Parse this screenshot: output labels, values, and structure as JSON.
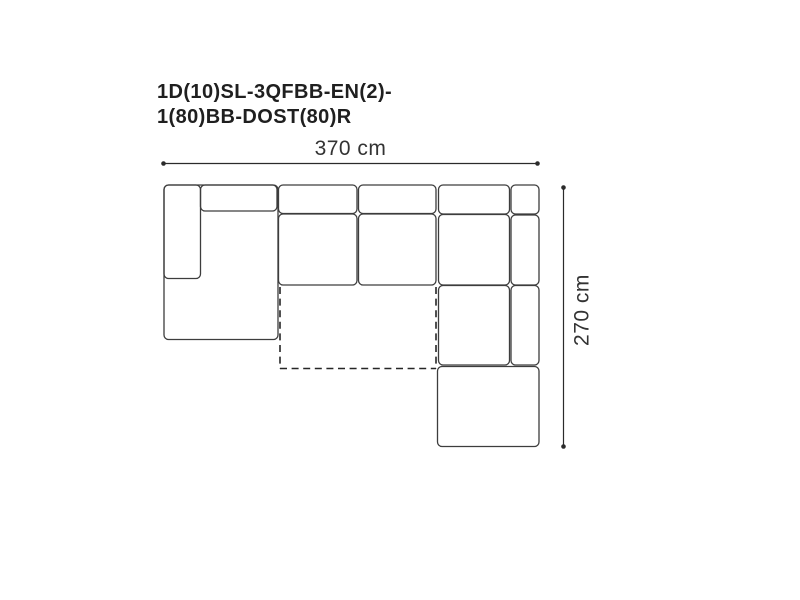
{
  "title": {
    "line1": "1D(10)SL-3QFBB-EN(2)-",
    "line2": "1(80)BB-DOST(80)R"
  },
  "dimensions": {
    "width_label": "370 cm",
    "depth_label": "270 cm"
  },
  "colors": {
    "background": "#ffffff",
    "module_stroke": "#3d3d3d",
    "dashed_stroke": "#262626",
    "dimension_stroke": "#2b2b2b",
    "title_text": "#1f1f1f",
    "dimension_text": "#333333"
  },
  "diagram": {
    "canvas": {
      "width": 800,
      "height": 600
    },
    "corner_radius": 4.5,
    "modules": [
      {
        "name": "left-chaise-outline",
        "x": 164,
        "y": 185,
        "w": 114,
        "h": 154.5
      },
      {
        "name": "left-armrest",
        "x": 164,
        "y": 185,
        "w": 36.5,
        "h": 93.5
      },
      {
        "name": "left-backrest",
        "x": 200.5,
        "y": 185,
        "w": 76.5,
        "h": 26
      },
      {
        "name": "middle-backrest-1",
        "x": 278.5,
        "y": 185,
        "w": 78.5,
        "h": 28.5
      },
      {
        "name": "middle-seat-1",
        "x": 278.5,
        "y": 214,
        "w": 78.5,
        "h": 71
      },
      {
        "name": "middle-backrest-2",
        "x": 358.5,
        "y": 185,
        "w": 77.5,
        "h": 28.5
      },
      {
        "name": "middle-seat-2",
        "x": 358.5,
        "y": 214,
        "w": 77.5,
        "h": 71
      },
      {
        "name": "right-backrest",
        "x": 438.5,
        "y": 185,
        "w": 71,
        "h": 29
      },
      {
        "name": "right-corner-piece",
        "x": 511,
        "y": 185,
        "w": 28,
        "h": 29
      },
      {
        "name": "right-seat-upper",
        "x": 438.5,
        "y": 214.5,
        "w": 71,
        "h": 70.5
      },
      {
        "name": "right-armrest-upper",
        "x": 511,
        "y": 215,
        "w": 28,
        "h": 70
      },
      {
        "name": "right-seat-lower",
        "x": 438.5,
        "y": 285.5,
        "w": 71,
        "h": 79.5
      },
      {
        "name": "right-armrest-lower",
        "x": 511,
        "y": 285.5,
        "w": 28,
        "h": 79.5
      },
      {
        "name": "ottoman",
        "x": 437.5,
        "y": 366.5,
        "w": 101.5,
        "h": 80
      }
    ],
    "pullout_bed_dashed": [
      {
        "name": "bed-left-edge",
        "x1": 280,
        "y1": 287,
        "x2": 280,
        "y2": 368.5
      },
      {
        "name": "bed-bottom-edge",
        "x1": 280,
        "y1": 368.5,
        "x2": 436,
        "y2": 368.5
      },
      {
        "name": "bed-right-edge",
        "x1": 436,
        "y1": 287,
        "x2": 436,
        "y2": 368.5
      }
    ],
    "dimension_lines": [
      {
        "name": "width-dimension-line",
        "x1": 163.5,
        "y1": 163.5,
        "x2": 537.5,
        "y2": 163.5
      },
      {
        "name": "depth-dimension-line",
        "x1": 563.5,
        "y1": 187.5,
        "x2": 563.5,
        "y2": 446.5
      }
    ],
    "dot_radius": 2.3
  }
}
